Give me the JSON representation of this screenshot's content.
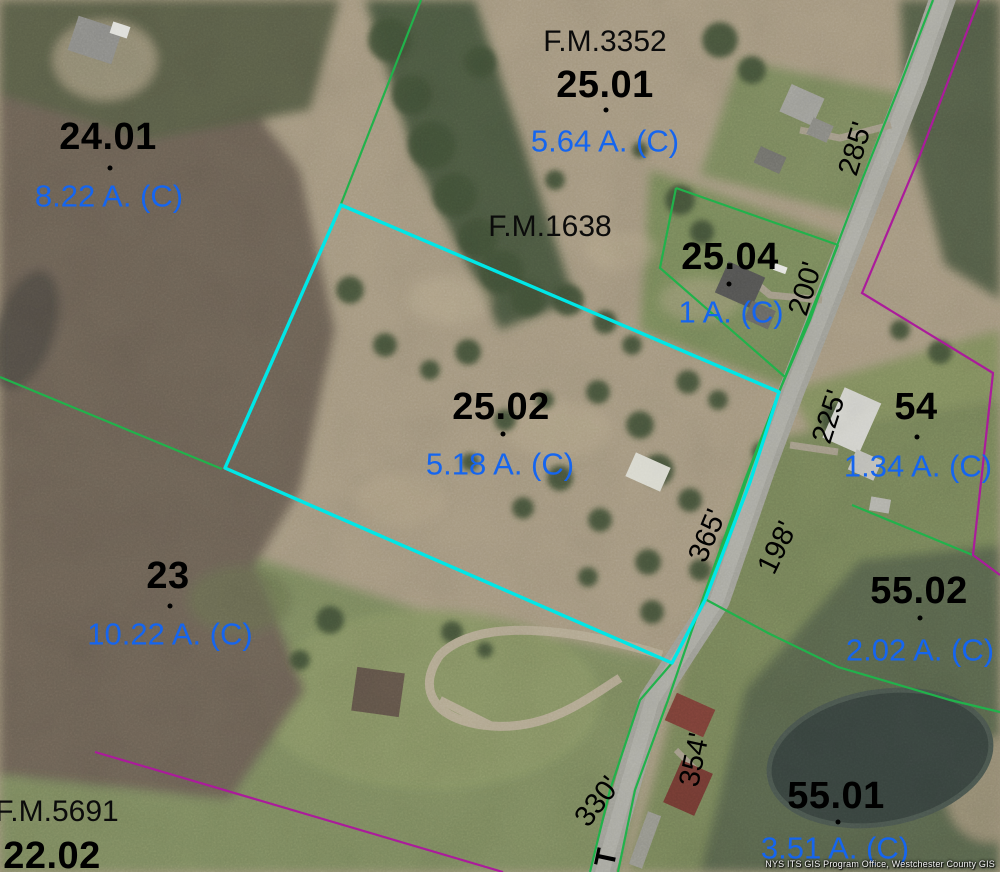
{
  "map": {
    "selected_parcel": "25.02",
    "colors": {
      "parcel_line_green": "#21b24b",
      "boundary_magenta": "#ab1b9b",
      "selected_outline_cyan": "#00e7e7",
      "parcel_id_text": "#000000",
      "acreage_text": "#1565ef"
    },
    "parcels": [
      {
        "id": "24.01",
        "area": "8.22 A. (C)"
      },
      {
        "id": "25.01",
        "area": "5.64 A. (C)",
        "filed_map": "F.M.3352"
      },
      {
        "id": "25.04",
        "area": "1 A. (C)"
      },
      {
        "id": "25.02",
        "area": "5.18 A. (C)",
        "filed_map": "F.M.1638",
        "selected": true
      },
      {
        "id": "54",
        "area": "1.34 A. (C)"
      },
      {
        "id": "23",
        "area": "10.22 A. (C)"
      },
      {
        "id": "55.02",
        "area": "2.02 A. (C)"
      },
      {
        "id": "55.01",
        "area": "3.51 A. (C)"
      },
      {
        "id": "22.02",
        "filed_map": "F.M.5691"
      }
    ],
    "frontage_dimensions": [
      "285'",
      "200'",
      "225'",
      "365'",
      "198'",
      "354'",
      "330'"
    ],
    "road_label_partial": "T",
    "watermark": "NYS ITS GIS Program Office, Westchester County GIS"
  }
}
